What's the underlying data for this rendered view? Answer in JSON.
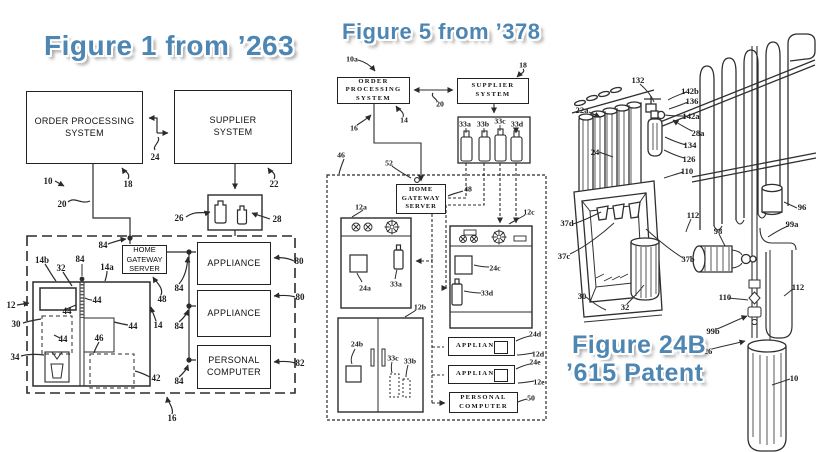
{
  "colors": {
    "title_blue": "#4d86b2",
    "ink": "#2b2b2b",
    "background": "#ffffff"
  },
  "fig1": {
    "title": "Figure 1 from ’263",
    "boxes": {
      "order_processing": "ORDER PROCESSING\nSYSTEM",
      "supplier": "SUPPLIER\nSYSTEM",
      "home_gateway": "HOME\nGATEWAY\nSERVER",
      "appliance_top": "APPLIANCE",
      "appliance_mid": "APPLIANCE",
      "personal_computer": "PERSONAL\nCOMPUTER"
    },
    "drawing_elements": [
      "refrigerator-with-dispenser",
      "two-supply-bottles",
      "dashed-home-boundary"
    ],
    "refs": [
      {
        "t": "10",
        "x": 48,
        "y": 181
      },
      {
        "t": "18",
        "x": 128,
        "y": 184
      },
      {
        "t": "24",
        "x": 155,
        "y": 157
      },
      {
        "t": "22",
        "x": 274,
        "y": 184
      },
      {
        "t": "20",
        "x": 62,
        "y": 204
      },
      {
        "t": "26",
        "x": 179,
        "y": 218
      },
      {
        "t": "28",
        "x": 277,
        "y": 219
      },
      {
        "t": "84",
        "x": 103,
        "y": 245
      },
      {
        "t": "14b",
        "x": 42,
        "y": 260
      },
      {
        "t": "32",
        "x": 61,
        "y": 268
      },
      {
        "t": "84",
        "x": 80,
        "y": 259
      },
      {
        "t": "14a",
        "x": 107,
        "y": 267
      },
      {
        "t": "12",
        "x": 11,
        "y": 305
      },
      {
        "t": "30",
        "x": 16,
        "y": 324
      },
      {
        "t": "34",
        "x": 15,
        "y": 357
      },
      {
        "t": "44",
        "x": 97,
        "y": 300
      },
      {
        "t": "44",
        "x": 67,
        "y": 311
      },
      {
        "t": "44",
        "x": 63,
        "y": 339
      },
      {
        "t": "44",
        "x": 133,
        "y": 326
      },
      {
        "t": "46",
        "x": 99,
        "y": 338
      },
      {
        "t": "42",
        "x": 156,
        "y": 378
      },
      {
        "t": "14",
        "x": 158,
        "y": 325
      },
      {
        "t": "48",
        "x": 162,
        "y": 299
      },
      {
        "t": "84",
        "x": 179,
        "y": 288
      },
      {
        "t": "84",
        "x": 179,
        "y": 326
      },
      {
        "t": "84",
        "x": 179,
        "y": 381
      },
      {
        "t": "80",
        "x": 299,
        "y": 261
      },
      {
        "t": "80",
        "x": 300,
        "y": 297
      },
      {
        "t": "82",
        "x": 300,
        "y": 363
      },
      {
        "t": "16",
        "x": 172,
        "y": 418
      }
    ]
  },
  "fig2": {
    "title": "Figure 5 from ’378",
    "boxes": {
      "order_processing": "ORDER\nPROCESSING\nSYSTEM",
      "supplier": "SUPPLIER\nSYSTEM",
      "home_gateway": "HOME\nGATEWAY\nSERVER",
      "appliance_d": "APPLIANCE",
      "appliance_e": "APPLIANCE",
      "personal_computer": "PERSONAL\nCOMPUTER"
    },
    "drawing_elements": [
      "bottle-rack-33a-33d",
      "range-12a",
      "refrigerator-12b",
      "range-12c",
      "dashed-home-boundary"
    ],
    "refs": [
      {
        "t": "10a",
        "x": 352,
        "y": 59
      },
      {
        "t": "18",
        "x": 523,
        "y": 65
      },
      {
        "t": "20",
        "x": 440,
        "y": 104
      },
      {
        "t": "14",
        "x": 404,
        "y": 120
      },
      {
        "t": "16",
        "x": 354,
        "y": 128
      },
      {
        "t": "46",
        "x": 341,
        "y": 155
      },
      {
        "t": "52",
        "x": 389,
        "y": 163
      },
      {
        "t": "48",
        "x": 468,
        "y": 189
      },
      {
        "t": "33a",
        "x": 465,
        "y": 124
      },
      {
        "t": "33b",
        "x": 483,
        "y": 124
      },
      {
        "t": "33c",
        "x": 500,
        "y": 121
      },
      {
        "t": "33d",
        "x": 517,
        "y": 124
      },
      {
        "t": "12a",
        "x": 361,
        "y": 207
      },
      {
        "t": "24a",
        "x": 365,
        "y": 288
      },
      {
        "t": "33a",
        "x": 396,
        "y": 284
      },
      {
        "t": "12b",
        "x": 420,
        "y": 307
      },
      {
        "t": "24b",
        "x": 357,
        "y": 344
      },
      {
        "t": "33c",
        "x": 393,
        "y": 358
      },
      {
        "t": "33b",
        "x": 410,
        "y": 361
      },
      {
        "t": "12c",
        "x": 529,
        "y": 212
      },
      {
        "t": "24c",
        "x": 495,
        "y": 268
      },
      {
        "t": "33d",
        "x": 487,
        "y": 293
      },
      {
        "t": "24d",
        "x": 535,
        "y": 334
      },
      {
        "t": "12d",
        "x": 538,
        "y": 354
      },
      {
        "t": "24e",
        "x": 535,
        "y": 362
      },
      {
        "t": "12e",
        "x": 539,
        "y": 382
      },
      {
        "t": "50",
        "x": 531,
        "y": 398
      }
    ]
  },
  "fig3": {
    "title_line1": "Figure 24B",
    "title_line2": "’615 Patent",
    "drawing_elements": [
      "condenser-coil-rack",
      "canister-group",
      "valve-and-cartridge",
      "dispenser-recess-with-nozzles",
      "cup",
      "pump",
      "supply-tubes",
      "filter-cylinder"
    ],
    "refs": [
      {
        "t": "132",
        "x": 638,
        "y": 80
      },
      {
        "t": "142b",
        "x": 690,
        "y": 91
      },
      {
        "t": "136",
        "x": 692,
        "y": 101
      },
      {
        "t": "142a",
        "x": 691,
        "y": 116
      },
      {
        "t": "28a",
        "x": 698,
        "y": 133
      },
      {
        "t": "134",
        "x": 690,
        "y": 145
      },
      {
        "t": "126",
        "x": 689,
        "y": 159
      },
      {
        "t": "110",
        "x": 687,
        "y": 171
      },
      {
        "t": "112",
        "x": 693,
        "y": 215
      },
      {
        "t": "22a",
        "x": 582,
        "y": 110
      },
      {
        "t": "24",
        "x": 595,
        "y": 152
      },
      {
        "t": "96",
        "x": 802,
        "y": 207
      },
      {
        "t": "99a",
        "x": 792,
        "y": 224
      },
      {
        "t": "98",
        "x": 718,
        "y": 231
      },
      {
        "t": "37d",
        "x": 567,
        "y": 223
      },
      {
        "t": "37c",
        "x": 564,
        "y": 256
      },
      {
        "t": "37b",
        "x": 688,
        "y": 259
      },
      {
        "t": "30",
        "x": 582,
        "y": 296
      },
      {
        "t": "32",
        "x": 625,
        "y": 307
      },
      {
        "t": "110",
        "x": 725,
        "y": 297
      },
      {
        "t": "112",
        "x": 798,
        "y": 287
      },
      {
        "t": "99b",
        "x": 713,
        "y": 331
      },
      {
        "t": "26",
        "x": 708,
        "y": 351
      },
      {
        "t": "10",
        "x": 794,
        "y": 378
      }
    ]
  }
}
